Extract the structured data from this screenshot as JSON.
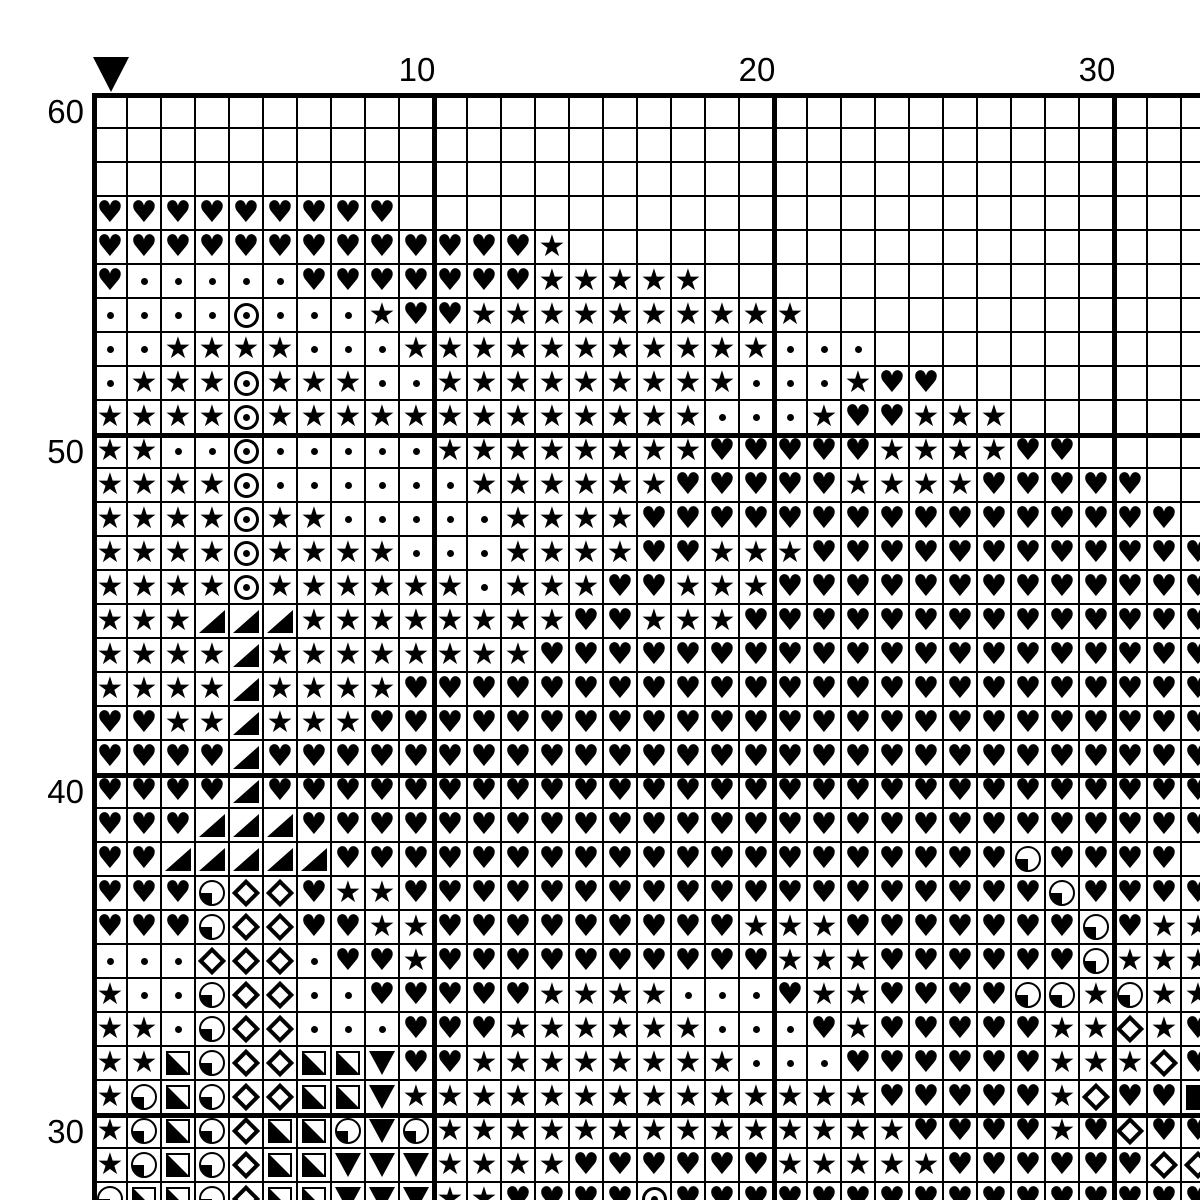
{
  "page": {
    "background_color": "#ffffff",
    "line_color": "#000000",
    "symbol_color": "#000000"
  },
  "chart": {
    "type": "cross-stitch-symbol-grid",
    "visible_columns": 33,
    "visible_rows": 33,
    "cell_size_px": 34,
    "column_labels": [
      {
        "text": "10",
        "column": 10
      },
      {
        "text": "20",
        "column": 20
      },
      {
        "text": "30",
        "column": 30
      }
    ],
    "row_labels": [
      {
        "text": "60",
        "row": 1
      },
      {
        "text": "50",
        "row": 11
      },
      {
        "text": "40",
        "row": 21
      },
      {
        "text": "30",
        "row": 31
      }
    ],
    "marker": {
      "column": 1,
      "shape": "down-triangle"
    },
    "thick_line_every": 10,
    "symbols": {
      ".": "blank",
      "H": "heart",
      "S": "star",
      "d": "dot",
      "O": "circle-dot",
      "T": "triangle-lower-right",
      "Q": "quarter-circle-lower-left",
      "M": "diamond-outline",
      "X": "square-lower-left-half",
      "V": "triangle-down",
      "F": "filled-square"
    },
    "glyphs": {
      "heart": "♥",
      "star": "★"
    },
    "rows": [
      ".................................",
      ".................................",
      ".................................",
      "HHHHHHHHH........................",
      "HHHHHHHHHHHHHS...................",
      "HdddddHHHHHHHSSSSS...............",
      "ddddOdddSHHSSSSSSSSSS............",
      "ddSSSSdddSSSSSSSSSSSddd..........",
      "dSSSOSSSddSSSSSSSSSdddSHH........",
      "SSSSOSSSSSSSSSSSSSdddSHHSSS......",
      "SSddOdddddSSSSSSSSHHHHHSSSSHH....",
      "SSSSOddddddSSSSSSHHHHHSSSSHHHHH..",
      "SSSSOSSdddddSSSSHHHHHHHHHHHHHHHH.",
      "SSSSOSSSSdddSSSSHHSSSHHHHHHHHHHHH",
      "SSSSOSSSSSSdSSSHHSSSHHHHHHHHHHHHH",
      "SSSTTTSSSSSSSSHHSSSHHHHHHHHHHHHHH",
      "SSSSTSSSSSSSSHHHHHHHHHHHHHHHHHHHH",
      "SSSSTSSSSHHHHHHHHHHHHHHHHHHHHHHHH",
      "HHSSTSSSHHHHHHHHHHHHHHHHHHHHHHHHH",
      "HHHHTHHHHHHHHHHHHHHHHHHHHHHHHHHHH",
      "HHHHTHHHHHHHHHHHHHHHHHHHHHHHHHHHH",
      "HHHTTTHHHHHHHHHHHHHHHHHHHHHHHHHHH",
      "HHTTTTTHHHHHHHHHHHHHHHHHHHHQHHHH",
      "HHHQMMHSSHHHHHHHHHHHHHHHHHHHQHHHH",
      "HHHQMMHHSSHHHHHHHHHSSSHHHHHHHQHSS",
      "dddMMMdHHSHHHHHHHHHHSSSHHHHHHQSSS",
      "SddQMMddHHHHHSSSSdddHSSHHHHQQSQSS",
      "SSdQMMdddHHHSSSSSSdddHSHHHHHSSMSH",
      "SSXQMMXXVHHSSSSSSSSdddHHHHHHSSSMH",
      "SQXQMMXXVSSSSSSSSSSSSSSHHHHHSMHHF",
      "SQXQMXXQVQSSSSSSSSSSSSSSHHHHSHMHH",
      "SQXQMXXVVVSSSSHHHHHHSSSSSHHHHHHMM",
      "QXXQMXXVVVSSHHHHOHHHHHHHHHHHHHHHH"
    ]
  }
}
